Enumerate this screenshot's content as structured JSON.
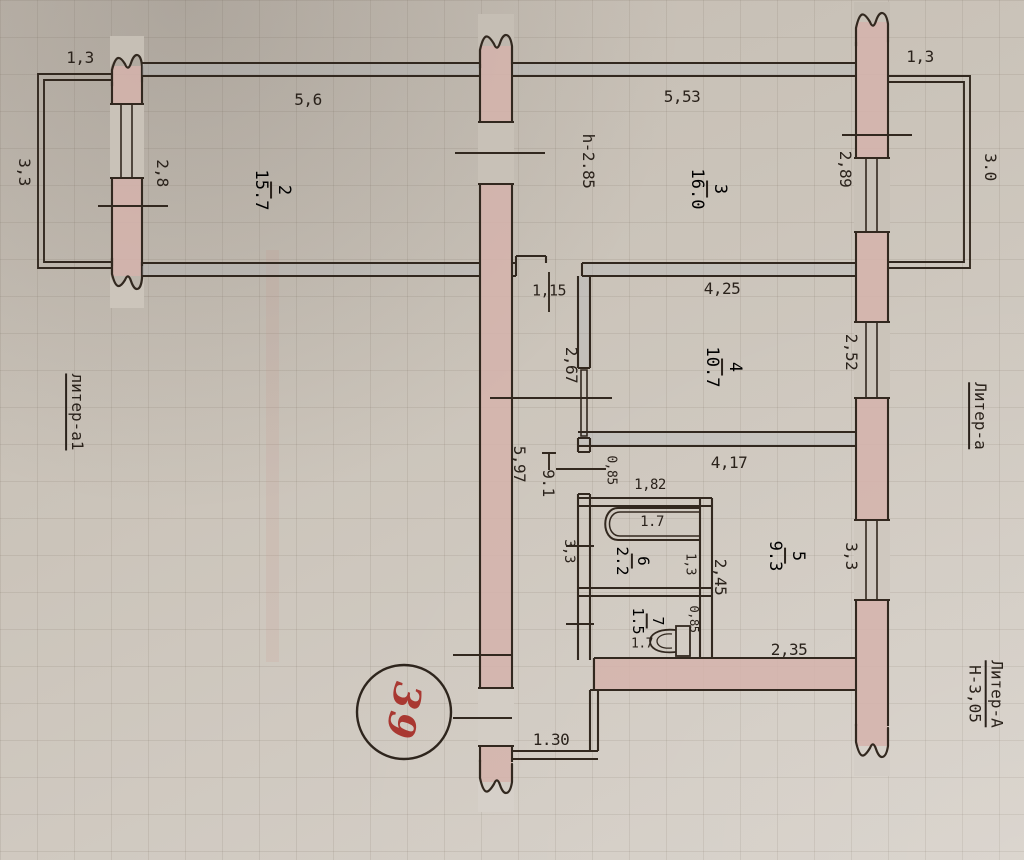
{
  "plan": {
    "apartment_number": "39",
    "annotations": {
      "left_wing": "литер-а1",
      "right_wing": "Литер-а",
      "building": "Литер-А",
      "building_height": "Н-3,05",
      "ceiling_height": "h-2.85"
    },
    "rooms": {
      "r2": {
        "number": "2",
        "area": "15.7"
      },
      "r3": {
        "number": "3",
        "area": "16.0"
      },
      "r4": {
        "number": "4",
        "area": "10.7"
      },
      "r5": {
        "number": "5",
        "area": "9.3"
      },
      "r6": {
        "number": "6",
        "area": "2.2"
      },
      "r7": {
        "number": "7",
        "area": "1.5"
      },
      "corridor": {
        "area": "9.1"
      }
    },
    "dimensions": {
      "balcony_left_width": "1,3",
      "balcony_left_depth": "3,3",
      "room2_width": "5,6",
      "room2_window": "2,8",
      "room3_width": "5,53",
      "room3_window": "2,89",
      "balcony_right_width": "1,3",
      "balcony_right_depth": "3.0",
      "corridor_width_top": "1,15",
      "room4_width": "4,25",
      "room4_depth_left": "2,67",
      "room4_window": "2,52",
      "corridor_length": "5,97",
      "entry_nook_depth": "0,85",
      "room5_width": "4,17",
      "bathroom_width": "1,82",
      "bathtub_length": "1.7",
      "bathroom_inner": "1,3",
      "corridor_side": "3,3",
      "room5_depth_left": "2,45",
      "room5_window": "3,3",
      "toilet_length": "1.7",
      "toilet_side": "0,85",
      "room5_bottom": "2,35",
      "entrance_width": "1.30"
    },
    "colors": {
      "paper": "#cbc4ba",
      "ink": "#32281f",
      "wall_highlight": "#d5b3ac",
      "handwriting": "#a93832"
    }
  }
}
